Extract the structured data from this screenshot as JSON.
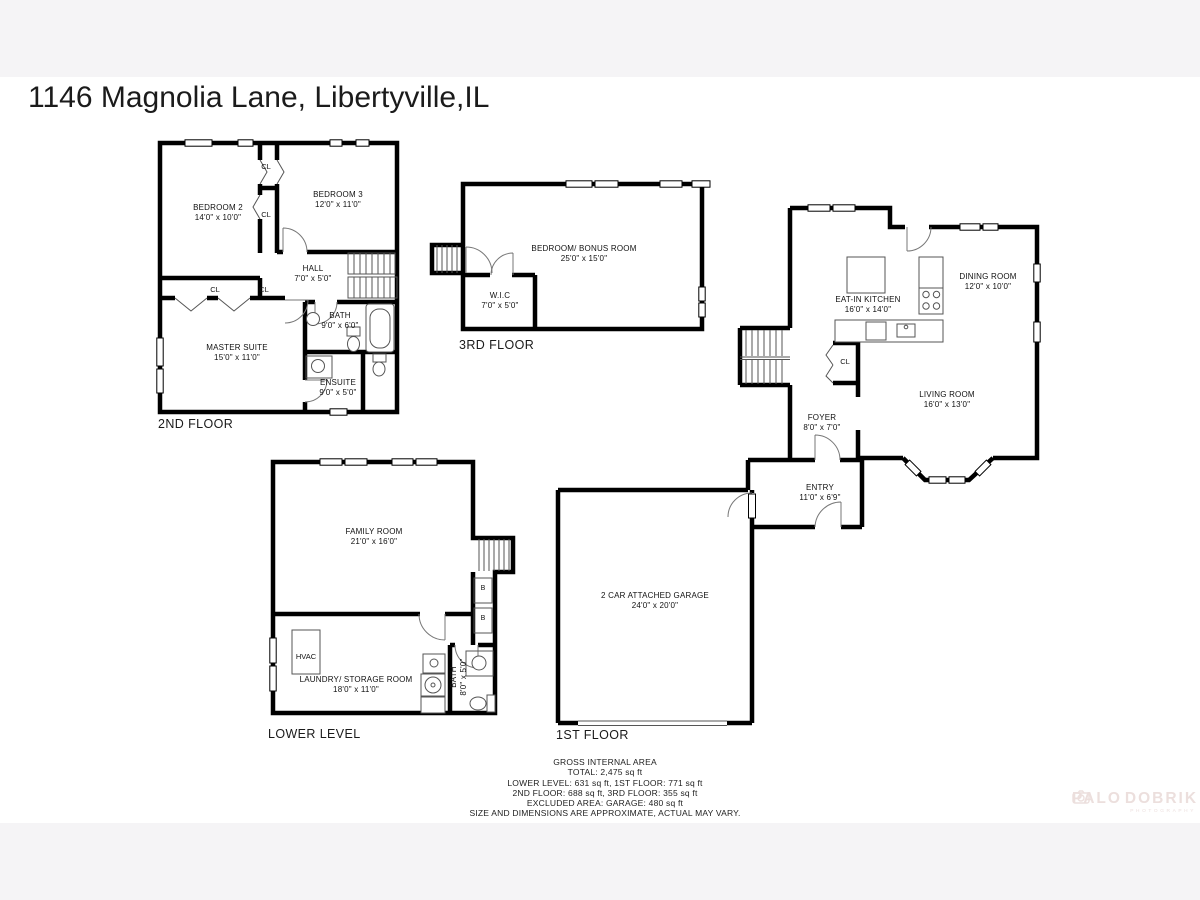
{
  "page": {
    "title": "1146 Magnolia Lane, Libertyville,IL"
  },
  "labels": {
    "closet": "CL",
    "builtin": "B",
    "hvac": "HVAC"
  },
  "floors": {
    "second": {
      "label": "2ND FLOOR",
      "rooms": {
        "bedroom2": {
          "name": "BEDROOM 2",
          "dims": "14'0\" x 10'0\""
        },
        "bedroom3": {
          "name": "BEDROOM 3",
          "dims": "12'0\" x 11'0\""
        },
        "hall": {
          "name": "HALL",
          "dims": "7'0\" x 5'0\""
        },
        "master": {
          "name": "MASTER SUITE",
          "dims": "15'0\" x 11'0\""
        },
        "bath": {
          "name": "BATH",
          "dims": "9'0\" x 6'0\""
        },
        "ensuite": {
          "name": "ENSUITE",
          "dims": "9'0\" x 5'0\""
        }
      }
    },
    "third": {
      "label": "3RD FLOOR",
      "rooms": {
        "bonus": {
          "name": "BEDROOM/ BONUS ROOM",
          "dims": "25'0\" x 15'0\""
        },
        "wic": {
          "name": "W.I.C",
          "dims": "7'0\" x 5'0\""
        }
      }
    },
    "first": {
      "label": "1ST FLOOR",
      "rooms": {
        "kitchen": {
          "name": "EAT-IN KITCHEN",
          "dims": "16'0\" x 14'0\""
        },
        "dining": {
          "name": "DINING ROOM",
          "dims": "12'0\" x 10'0\""
        },
        "living": {
          "name": "LIVING ROOM",
          "dims": "16'0\" x 13'0\""
        },
        "foyer": {
          "name": "FOYER",
          "dims": "8'0\" x 7'0\""
        },
        "entry": {
          "name": "ENTRY",
          "dims": "11'0\" x 6'9\""
        },
        "garage": {
          "name": "2 CAR ATTACHED GARAGE",
          "dims": "24'0\" x 20'0\""
        }
      }
    },
    "lower": {
      "label": "LOWER LEVEL",
      "rooms": {
        "family": {
          "name": "FAMILY ROOM",
          "dims": "21'0\" x 16'0\""
        },
        "laundry": {
          "name": "LAUNDRY/ STORAGE ROOM",
          "dims": "18'0\" x 11'0\""
        },
        "bath": {
          "name": "BATH",
          "dims": "8'0\" x 5'0\""
        }
      }
    }
  },
  "footer": {
    "lines": [
      "GROSS INTERNAL AREA",
      "TOTAL: 2,475 sq ft",
      "LOWER LEVEL: 631 sq ft, 1ST FLOOR: 771 sq ft",
      "2ND FLOOR: 688 sq ft, 3RD FLOOR: 355 sq ft",
      "EXCLUDED AREA: GARAGE: 480 sq ft",
      "SIZE AND DIMENSIONS ARE APPROXIMATE, ACTUAL MAY VARY."
    ]
  },
  "watermark": {
    "left": "PALO",
    "right": "DOBRIK",
    "sub": "PHOTOGRAPHY"
  }
}
